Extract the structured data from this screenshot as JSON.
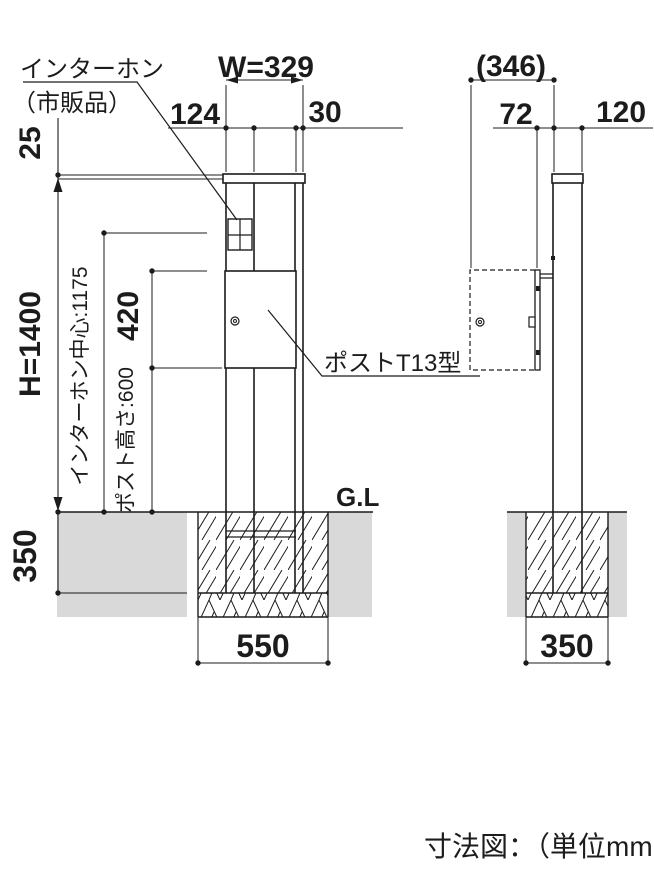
{
  "caption": "寸法図：（単位mm）",
  "colors": {
    "line": "#1c1c1c",
    "soil": "#d9d9d9",
    "background": "#ffffff"
  },
  "front_view": {
    "part_labels": {
      "intercom_line1": "インターホン",
      "intercom_line2": "（市販品）",
      "post_box": "ポストT13型",
      "ground_level": "G.L"
    },
    "dimensions": {
      "cap_width": "W=329",
      "intercom_offset": "124",
      "edge_offset": "30",
      "cap_clearance": "25",
      "overall_height": "H=1400",
      "intercom_center_height": "インターホン中心:1175",
      "post_box_height": "420",
      "post_bottom_height": "ポスト高さ:600",
      "embed_depth": "350",
      "footing_width": "550"
    }
  },
  "side_view": {
    "dimensions": {
      "overall_depth": "(346)",
      "box_depth": "72",
      "post_depth": "120",
      "footing_width": "350"
    }
  }
}
